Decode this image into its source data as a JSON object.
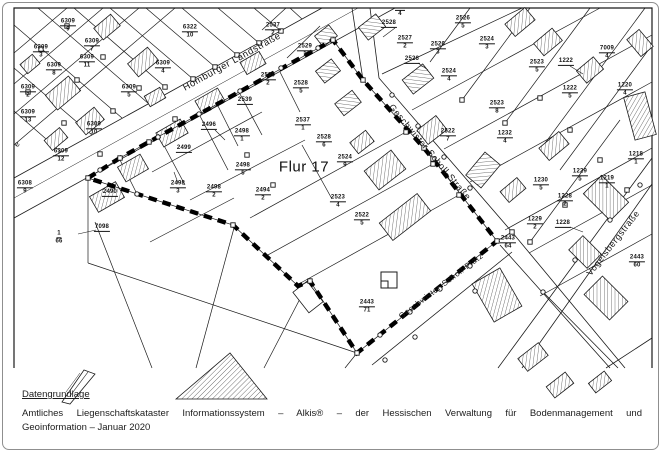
{
  "ink": "#1a1a1a",
  "page": {
    "background": "#ffffff",
    "border_color": "#8f8f8f"
  },
  "map": {
    "flur_label": {
      "text": "Flur 17",
      "x": 304,
      "y": 167
    },
    "street_labels": [
      {
        "name": "Homburger Landstraße",
        "x": 232,
        "y": 62,
        "rot": -29,
        "size": 9.5
      },
      {
        "name": "Geschwister-Scholl-Straße",
        "x": 430,
        "y": 152,
        "rot": 50,
        "size": 9
      },
      {
        "name": "Geschwister-Scholl-Platz",
        "x": 441,
        "y": 286,
        "rot": -37,
        "size": 8
      },
      {
        "name": "Vogelsbergstraße",
        "x": 613,
        "y": 243,
        "rot": -52,
        "size": 9
      },
      {
        "name": "e",
        "x": 17,
        "y": 144,
        "rot": -55,
        "size": 8
      }
    ],
    "parcel_labels": [
      {
        "n": "6309",
        "d": "9",
        "x": 68,
        "y": 26
      },
      {
        "n": "6309",
        "d": "3",
        "x": 41,
        "y": 52
      },
      {
        "n": "6309",
        "d": "7",
        "x": 92,
        "y": 46
      },
      {
        "n": "6309",
        "d": "11",
        "x": 87,
        "y": 62
      },
      {
        "n": "6309",
        "d": "8",
        "x": 54,
        "y": 70
      },
      {
        "n": "6309",
        "d": "4",
        "x": 163,
        "y": 68
      },
      {
        "n": "6309",
        "d": "2",
        "x": 28,
        "y": 92
      },
      {
        "n": "6309",
        "d": "5",
        "x": 129,
        "y": 92
      },
      {
        "n": "6309",
        "d": "13",
        "x": 28,
        "y": 117
      },
      {
        "n": "6309",
        "d": "10",
        "x": 94,
        "y": 129
      },
      {
        "n": "6309",
        "d": "12",
        "x": 61,
        "y": 156
      },
      {
        "n": "6308",
        "d": "9",
        "x": 25,
        "y": 188
      },
      {
        "n": "6322",
        "d": "10",
        "x": 190,
        "y": 32
      },
      {
        "n": "1",
        "d": "66",
        "x": 59,
        "y": 238
      },
      {
        "n": "2537",
        "d": "2",
        "x": 273,
        "y": 30
      },
      {
        "n": "2529",
        "d": "1",
        "x": 305,
        "y": 51
      },
      {
        "n": "2530",
        "d": "2",
        "x": 268,
        "y": 80
      },
      {
        "n": "2528",
        "d": "5",
        "x": 301,
        "y": 88
      },
      {
        "n": "2539",
        "d": "",
        "x": 245,
        "y": 101
      },
      {
        "n": "2496",
        "d": "",
        "x": 209,
        "y": 126
      },
      {
        "n": "2498",
        "d": "1",
        "x": 242,
        "y": 136
      },
      {
        "n": "2537",
        "d": "1",
        "x": 303,
        "y": 125
      },
      {
        "n": "2528",
        "d": "6",
        "x": 324,
        "y": 142
      },
      {
        "n": "2499",
        "d": "",
        "x": 184,
        "y": 149
      },
      {
        "n": "2498",
        "d": "5",
        "x": 243,
        "y": 170
      },
      {
        "n": "2490",
        "d": "",
        "x": 110,
        "y": 193
      },
      {
        "n": "2498",
        "d": "3",
        "x": 178,
        "y": 188
      },
      {
        "n": "2498",
        "d": "2",
        "x": 214,
        "y": 192
      },
      {
        "n": "2494",
        "d": "2",
        "x": 263,
        "y": 195
      },
      {
        "n": "7098",
        "d": "",
        "x": 102,
        "y": 228
      },
      {
        "n": "2524",
        "d": "9",
        "x": 345,
        "y": 162
      },
      {
        "n": "2523",
        "d": "4",
        "x": 338,
        "y": 202
      },
      {
        "n": "2522",
        "d": "5",
        "x": 362,
        "y": 220
      },
      {
        "n": "2528",
        "d": "",
        "x": 389,
        "y": 24
      },
      {
        "n": "2527",
        "d": "2",
        "x": 405,
        "y": 43
      },
      {
        "n": "2526",
        "d": "3",
        "x": 438,
        "y": 49
      },
      {
        "n": "2526",
        "d": "",
        "x": 412,
        "y": 60
      },
      {
        "n": "2526",
        "d": "5",
        "x": 463,
        "y": 23
      },
      {
        "n": "2524",
        "d": "3",
        "x": 487,
        "y": 44
      },
      {
        "n": "2524",
        "d": "4",
        "x": 449,
        "y": 76
      },
      {
        "n": "2523",
        "d": "5",
        "x": 537,
        "y": 67
      },
      {
        "n": "1222",
        "d": "",
        "x": 566,
        "y": 62
      },
      {
        "n": "7009",
        "d": "4",
        "x": 607,
        "y": 53
      },
      {
        "n": "1222",
        "d": "5",
        "x": 570,
        "y": 93
      },
      {
        "n": "1220",
        "d": "4",
        "x": 625,
        "y": 90
      },
      {
        "n": "2523",
        "d": "8",
        "x": 497,
        "y": 108
      },
      {
        "n": "1232",
        "d": "4",
        "x": 505,
        "y": 138
      },
      {
        "n": "2522",
        "d": "7",
        "x": 448,
        "y": 136
      },
      {
        "n": "1230",
        "d": "5",
        "x": 541,
        "y": 185
      },
      {
        "n": "1229",
        "d": "5",
        "x": 580,
        "y": 176
      },
      {
        "n": "1218",
        "d": "1",
        "x": 636,
        "y": 159
      },
      {
        "n": "1219",
        "d": "1",
        "x": 607,
        "y": 183
      },
      {
        "n": "1228",
        "d": "2",
        "x": 565,
        "y": 201
      },
      {
        "n": "1229",
        "d": "2",
        "x": 535,
        "y": 224
      },
      {
        "n": "1228",
        "d": "",
        "x": 563,
        "y": 224
      },
      {
        "n": "2443",
        "d": "64",
        "x": 508,
        "y": 243
      },
      {
        "n": "2443",
        "d": "71",
        "x": 367,
        "y": 307
      },
      {
        "n": "2443",
        "d": "60",
        "x": 637,
        "y": 262
      },
      {
        "n": "",
        "d": "4",
        "x": 400,
        "y": 13
      }
    ]
  },
  "footer": {
    "heading": "Datengrundlage",
    "line1": "Amtliches Liegenschaftskataster Informationssystem – Alkis® – der Hessischen Verwaltung für Bodenmanagement und",
    "line2": "Geoinformation – Januar 2020"
  }
}
